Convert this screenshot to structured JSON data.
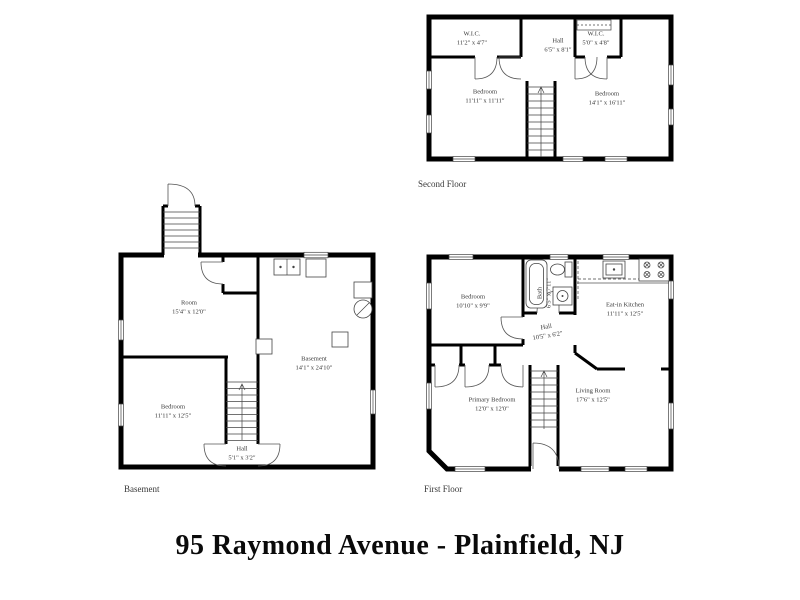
{
  "title": "95 Raymond Avenue - Plainfield, NJ",
  "colors": {
    "wall": "#000000",
    "thin_line": "#555555",
    "text": "#3a3a3a"
  },
  "floors": {
    "second": {
      "label": "Second Floor",
      "rooms": {
        "wic_left": {
          "name": "W.I.C.",
          "dims": "11'2\" x 4'7\""
        },
        "hall": {
          "name": "Hall",
          "dims": "6'5\" x 8'1\""
        },
        "wic_right": {
          "name": "W.I.C.",
          "dims": "5'0\" x 4'8\""
        },
        "bedroom_left": {
          "name": "Bedroom",
          "dims": "11'11\" x 11'11\""
        },
        "bedroom_right": {
          "name": "Bedroom",
          "dims": "14'1\" x 16'11\""
        }
      }
    },
    "basement": {
      "label": "Basement",
      "rooms": {
        "room": {
          "name": "Room",
          "dims": "15'4\" x 12'0\""
        },
        "bedroom": {
          "name": "Bedroom",
          "dims": "11'11\" x 12'5\""
        },
        "basement": {
          "name": "Basement",
          "dims": "14'1\" x 24'10\""
        },
        "hall": {
          "name": "Hall",
          "dims": "5'1\" x 3'2\""
        }
      }
    },
    "first": {
      "label": "First Floor",
      "rooms": {
        "bedroom": {
          "name": "Bedroom",
          "dims": "10'10\" x 9'9\""
        },
        "bath": {
          "name": "Bath",
          "dims": "6'5\" x 7'11\""
        },
        "kitchen": {
          "name": "Eat-in Kitchen",
          "dims": "11'11\" x 12'5\""
        },
        "hall": {
          "name": "Hall",
          "dims": "10'5\" x 6'2\""
        },
        "primary_bedroom": {
          "name": "Primary Bedroom",
          "dims": "12'0\" x 12'0\""
        },
        "living_room": {
          "name": "Living Room",
          "dims": "17'6\" x 12'5\""
        }
      }
    }
  }
}
